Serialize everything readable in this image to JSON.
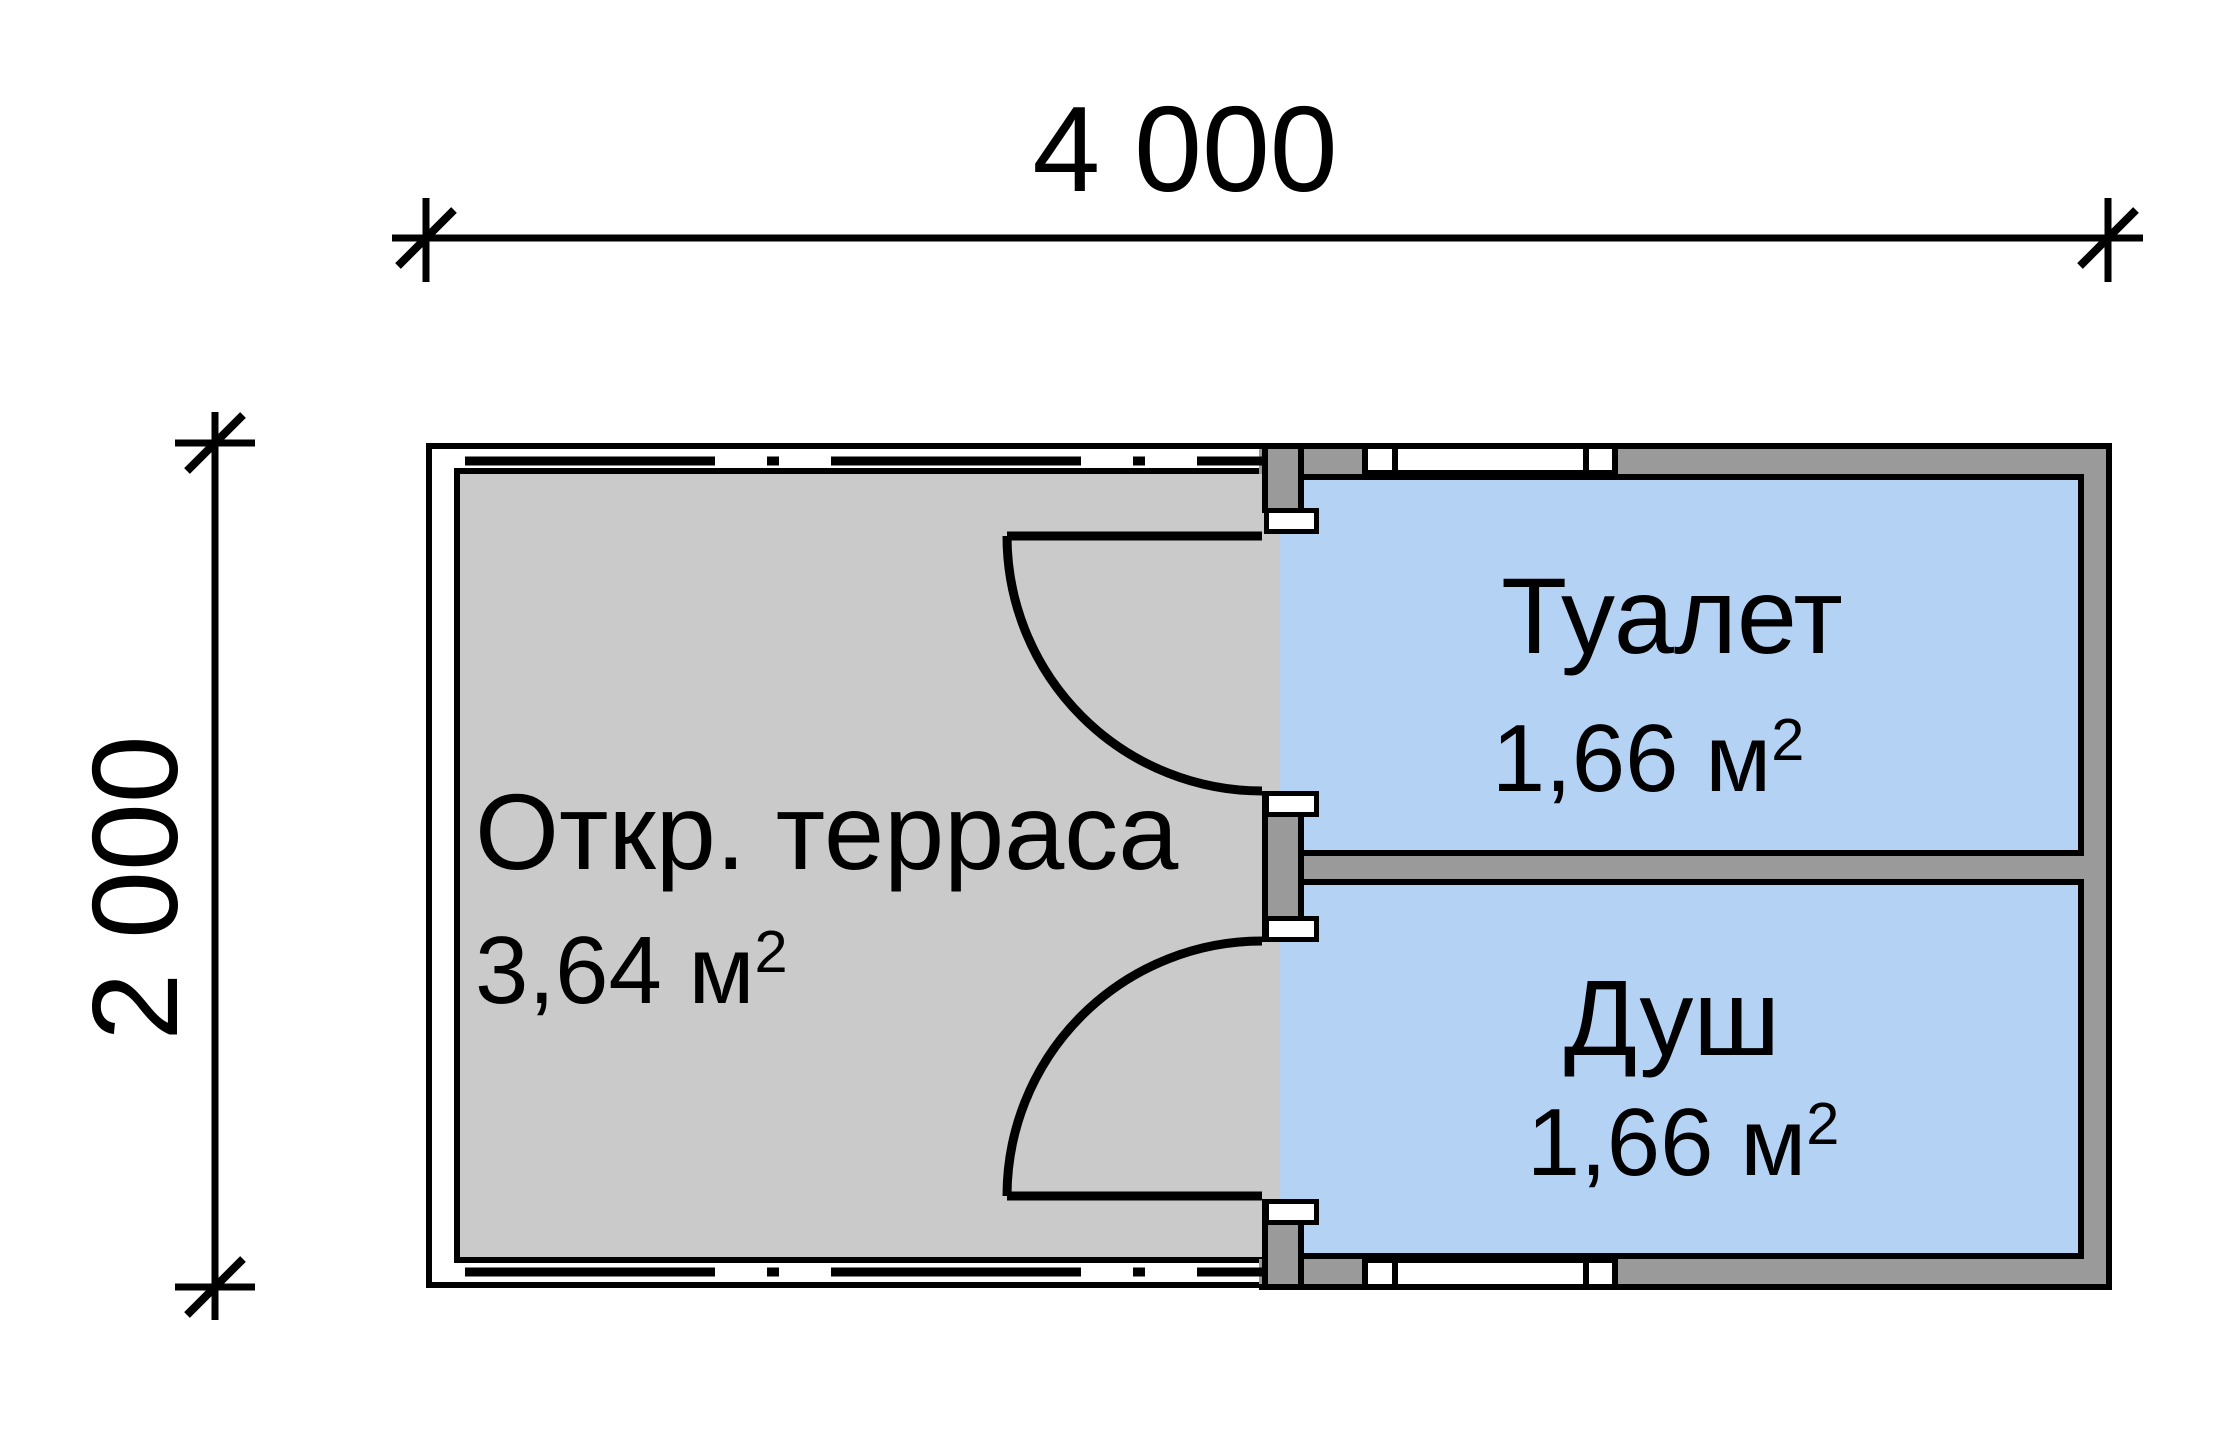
{
  "plan": {
    "type": "floor-plan",
    "dimensions": {
      "width_label": "4 000",
      "height_label": "2 000"
    },
    "rooms": {
      "terrace": {
        "name": "Откр. терраса",
        "area": "3,64 м",
        "area_sup": "2"
      },
      "toilet": {
        "name": "Туалет",
        "area": "1,66 м",
        "area_sup": "2"
      },
      "shower": {
        "name": "Душ",
        "area": "1,66 м",
        "area_sup": "2"
      }
    },
    "colors": {
      "room_fill": "#b4d2f4",
      "terrace_fill": "#cacaca",
      "wall_fill": "#9a9a9a",
      "line": "#000000",
      "background": "#ffffff"
    }
  }
}
